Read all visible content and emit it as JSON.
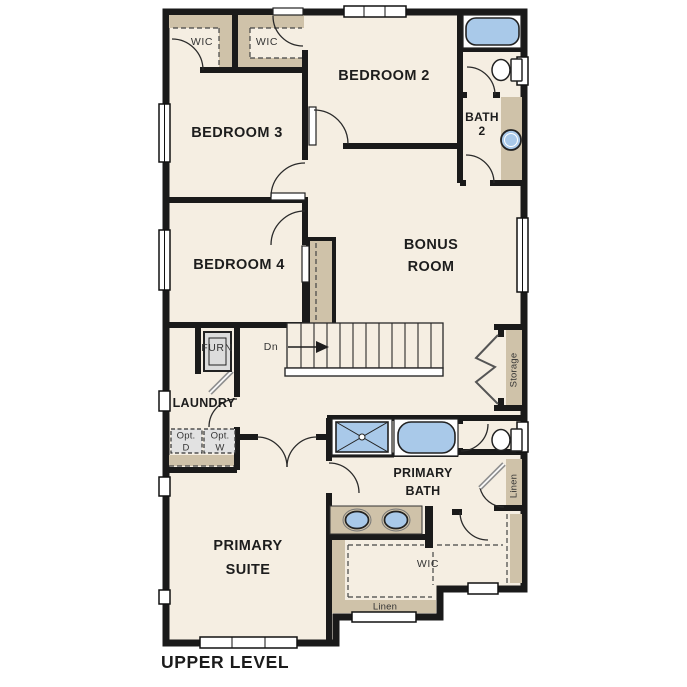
{
  "header": {
    "level_label": "UPPER LEVEL"
  },
  "labels": {
    "wic_top_left": "WIC",
    "wic_top_mid": "WIC",
    "bedroom_2": "BEDROOM 2",
    "bath_2": {
      "line1": "BATH",
      "line2": "2"
    },
    "bedroom_3": "BEDROOM 3",
    "bedroom_4": "BEDROOM 4",
    "bonus_room": {
      "line1": "BONUS",
      "line2": "ROOM"
    },
    "stairs_direction": "Dn",
    "storage": "Storage",
    "furnace": "FURN",
    "laundry": "LAUNDRY",
    "optional_dryer": {
      "line1": "Opt.",
      "line2": "D"
    },
    "optional_washer": {
      "line1": "Opt.",
      "line2": "W"
    },
    "primary_bath": {
      "line1": "PRIMARY",
      "line2": "BATH"
    },
    "linen_right": "Linen",
    "primary_suite": {
      "line1": "PRIMARY",
      "line2": "SUITE"
    },
    "wic_primary": "WIC",
    "linen_bottom": "Linen"
  },
  "colors": {
    "floor": "#f5eee2",
    "wall": "#1a1a1a",
    "shelf_tan": "#cfc2a9",
    "fixture_blue": "#a9c9e9",
    "fixture_gray": "#dcdcdc",
    "window_white": "#ffffff"
  }
}
